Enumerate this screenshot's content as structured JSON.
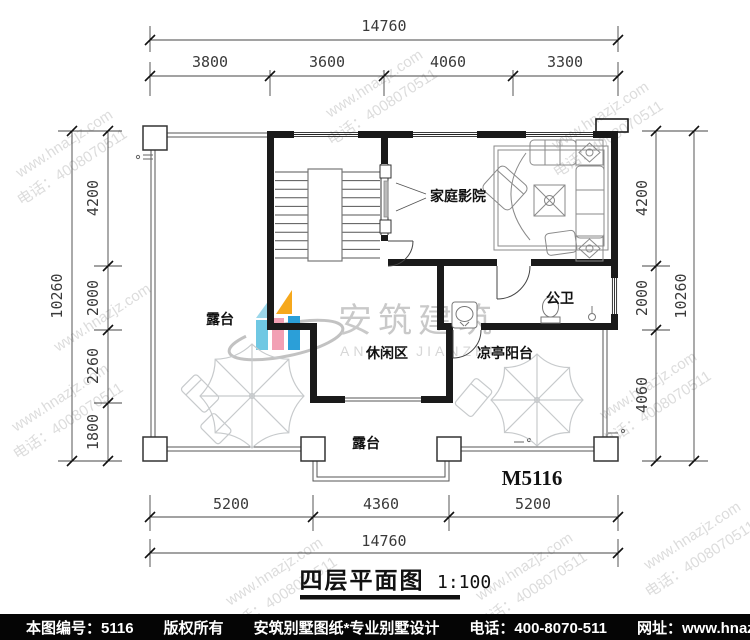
{
  "watermark": {
    "url": "www.hnazjz.com",
    "phone": "电话：4008070511",
    "brand": "安筑建筑",
    "brand_en": "ANZHU JIANZHU"
  },
  "dims": {
    "top": {
      "total": "14760",
      "segments": [
        "3800",
        "3600",
        "4060",
        "3300"
      ]
    },
    "left": {
      "total": "10260",
      "segments": [
        "4200",
        "2000",
        "2260",
        "1800"
      ]
    },
    "right": {
      "total": "10260",
      "segments": [
        "4200",
        "2000",
        "4060"
      ]
    },
    "bottom": {
      "total": "14760",
      "segments": [
        "5200",
        "4360",
        "5200"
      ]
    }
  },
  "labels": {
    "terrace_left": "露台",
    "home_theater": "家庭影院",
    "bathroom": "公卫",
    "leisure": "休闲区",
    "pavilion": "凉亭阳台",
    "terrace_bottom": "露台",
    "model_no": "M5116"
  },
  "title": {
    "name": "四层平面图",
    "scale": "1:100"
  },
  "footer": {
    "items": [
      "本图编号：5116",
      "版权所有",
      "安筑别墅图纸*专业别墅设计",
      "电话：400-8070-511",
      "网址：www.hnazjz.com"
    ]
  },
  "colors": {
    "wall": "#1a1a1a",
    "logo_orange": "#f6a81c",
    "logo_cyan": "#6fc8e3",
    "logo_pink": "#f2a0b4",
    "logo_blue": "#2b9fd8",
    "footer_bg": "#000000"
  }
}
